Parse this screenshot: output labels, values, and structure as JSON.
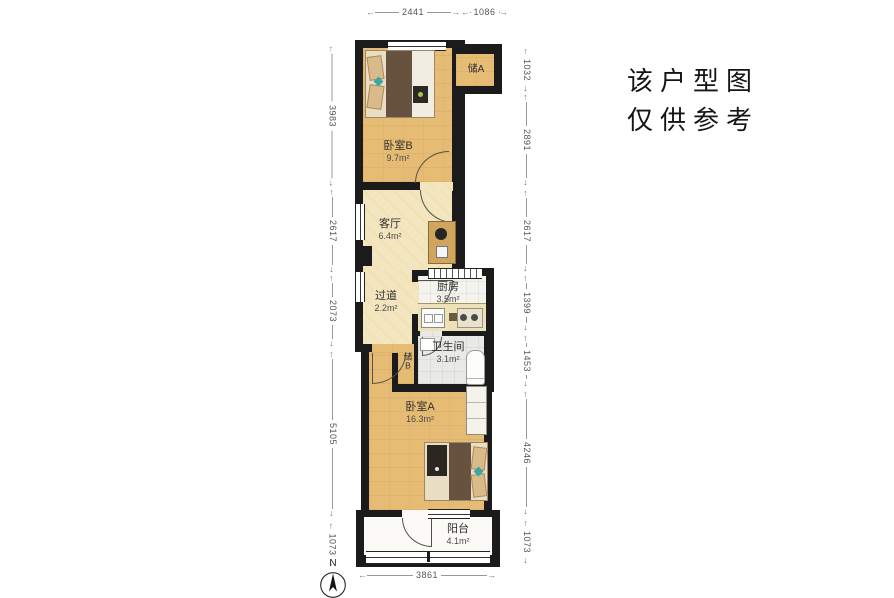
{
  "disclaimer": {
    "line1": "该户型图",
    "line2": "仅供参考"
  },
  "compass": {
    "north_label": "N"
  },
  "dimensions": {
    "top": [
      "2441",
      "1086"
    ],
    "left": [
      "3983",
      "2617",
      "2073",
      "5105",
      "1073"
    ],
    "right": [
      "1032",
      "2891",
      "2617",
      "1399",
      "1453",
      "4246",
      "1073"
    ],
    "bottom": [
      "3861"
    ]
  },
  "rooms": {
    "storage_a": {
      "name": "储A"
    },
    "bedroom_b": {
      "name": "卧室B",
      "area": "9.7m²"
    },
    "living": {
      "name": "客厅",
      "area": "6.4m²"
    },
    "hallway": {
      "name": "过道",
      "area": "2.2m²"
    },
    "kitchen": {
      "name": "厨房",
      "area": "3.5m²"
    },
    "bathroom": {
      "name": "卫生间",
      "area": "3.1m²"
    },
    "storage_b": {
      "name": "储B"
    },
    "bedroom_a": {
      "name": "卧室A",
      "area": "16.3m²"
    },
    "balcony": {
      "name": "阳台",
      "area": "4.1m²"
    }
  },
  "colors": {
    "wall": "#1b1b1b",
    "wood_floor": "#e6bc75",
    "pale_floor": "#f3e6bf",
    "kitchen_floor": "#f4f3ee",
    "bathroom_floor": "#e9e9e5",
    "balcony_floor": "#fbfaf6",
    "accent_teal": "#3aa8a0",
    "dimension_text": "#555555"
  }
}
